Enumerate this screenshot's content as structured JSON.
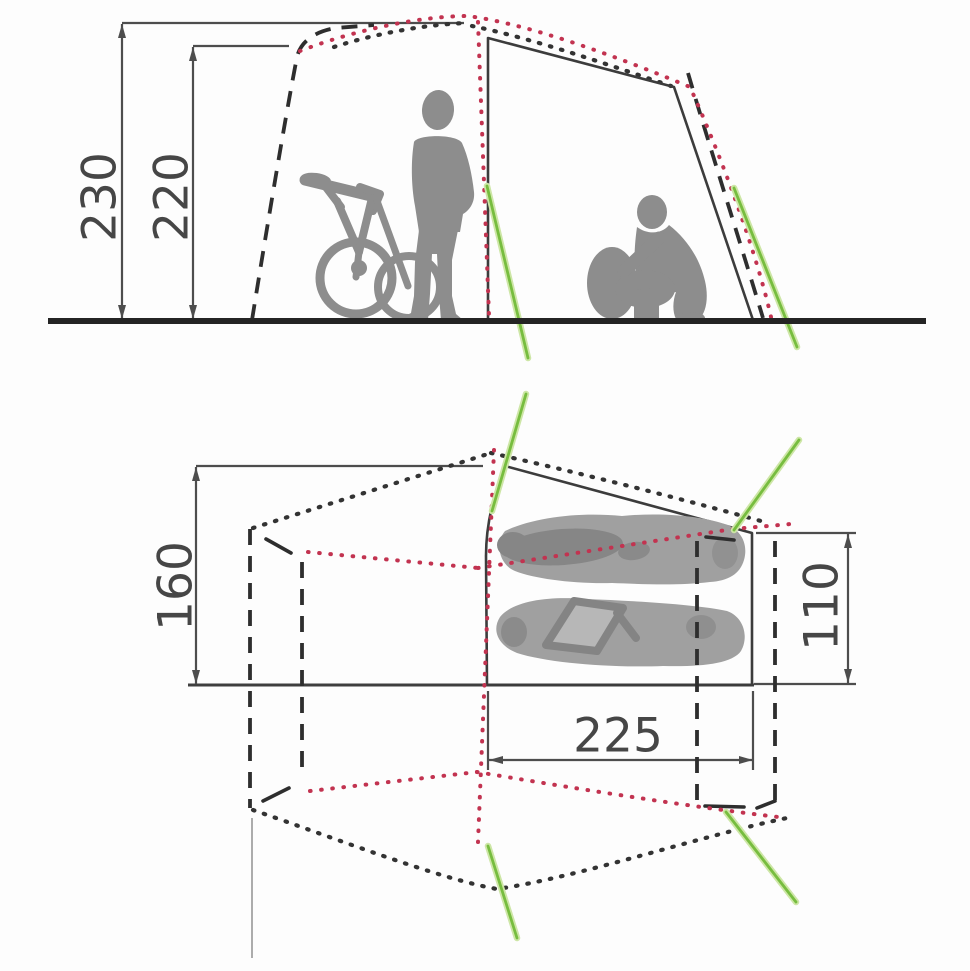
{
  "diagram": {
    "subject": "tent-dimensions",
    "views": {
      "side_elevation": {
        "name": "side elevation with figures for scale",
        "dimensions": [
          {
            "id": "outer-peak-height",
            "value": "230"
          },
          {
            "id": "inner-peak-height",
            "value": "220"
          }
        ]
      },
      "floor_plan": {
        "name": "floor plan with sleeping area",
        "dimensions": [
          {
            "id": "front-width",
            "value": "160"
          },
          {
            "id": "rear-inner-width",
            "value": "110"
          },
          {
            "id": "inner-length",
            "value": "225"
          }
        ]
      }
    },
    "colors": {
      "solid_outline": "#3c3c3c",
      "dimension_lines": "#4d4d4d",
      "inner_tent_fill": "#dadada",
      "silhouette_gray": "#8d8d8d",
      "red_dotted": "#c23350",
      "guyline_green": "#77bd3f"
    }
  }
}
